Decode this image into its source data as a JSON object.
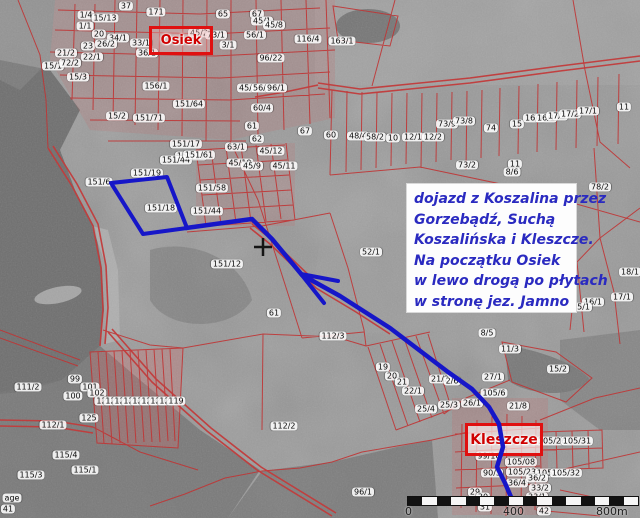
{
  "map": {
    "towns": [
      {
        "name": "Osiek"
      },
      {
        "name": "Kleszcze"
      }
    ],
    "note": {
      "lines": [
        "dojazd z Koszalina przez",
        "Gorzebądź, Suchą",
        "Koszalińska i Kleszcze.",
        "Na początku Osiek",
        "w lewo drogą po płytach",
        "w stronę jez. Jamno"
      ]
    },
    "scalebar": {
      "start_label": "0",
      "mid_label": "400",
      "end_label": "800m",
      "segments": 16
    },
    "colors": {
      "route_blue": "#1616c8",
      "cadastral_red": "#c03434",
      "town_label_red": "#cf0000",
      "note_text_blue": "#2a2ac0",
      "background_gray": "#989898"
    },
    "route": {
      "points": "186,228 252,219 272,239 302,275 340,296 390,328 448,372 472,389 489,407 499,424 503,447 497,467 505,483 511,497",
      "arrow_points": "338,281 301,274 324,303",
      "highlight_polygon": "111,183 167,177 187,228 143,234"
    },
    "parcel_labels": [
      {
        "t": "37",
        "x": 126,
        "y": 6
      },
      {
        "t": "1/4",
        "x": 86,
        "y": 15
      },
      {
        "t": "15/13",
        "x": 105,
        "y": 18
      },
      {
        "t": "171",
        "x": 156,
        "y": 12
      },
      {
        "t": "65",
        "x": 223,
        "y": 14
      },
      {
        "t": "67",
        "x": 257,
        "y": 14
      },
      {
        "t": "45/1",
        "x": 262,
        "y": 21
      },
      {
        "t": "45/8",
        "x": 274,
        "y": 25
      },
      {
        "t": "1/1",
        "x": 85,
        "y": 26
      },
      {
        "t": "20",
        "x": 99,
        "y": 34
      },
      {
        "t": "34/1",
        "x": 118,
        "y": 38
      },
      {
        "t": "23",
        "x": 88,
        "y": 46
      },
      {
        "t": "26/2",
        "x": 106,
        "y": 44
      },
      {
        "t": "33/1",
        "x": 141,
        "y": 43
      },
      {
        "t": "36/1",
        "x": 147,
        "y": 53
      },
      {
        "t": "21/2",
        "x": 66,
        "y": 53
      },
      {
        "t": "22/1",
        "x": 92,
        "y": 57
      },
      {
        "t": "15/1",
        "x": 53,
        "y": 66
      },
      {
        "t": "72/2",
        "x": 70,
        "y": 63
      },
      {
        "t": "15/3",
        "x": 78,
        "y": 77
      },
      {
        "t": "45/2",
        "x": 199,
        "y": 33
      },
      {
        "t": "73/1",
        "x": 216,
        "y": 35
      },
      {
        "t": "3/1",
        "x": 228,
        "y": 45
      },
      {
        "t": "56/1",
        "x": 255,
        "y": 35
      },
      {
        "t": "96/22",
        "x": 271,
        "y": 58
      },
      {
        "t": "116/4",
        "x": 308,
        "y": 39
      },
      {
        "t": "45/7",
        "x": 248,
        "y": 88
      },
      {
        "t": "56/7",
        "x": 262,
        "y": 88
      },
      {
        "t": "96/1",
        "x": 276,
        "y": 88
      },
      {
        "t": "156/1",
        "x": 156,
        "y": 86
      },
      {
        "t": "151/64",
        "x": 189,
        "y": 104
      },
      {
        "t": "15/2",
        "x": 117,
        "y": 116
      },
      {
        "t": "151/71",
        "x": 149,
        "y": 118
      },
      {
        "t": "60/4",
        "x": 262,
        "y": 108
      },
      {
        "t": "61",
        "x": 252,
        "y": 126
      },
      {
        "t": "67",
        "x": 305,
        "y": 131
      },
      {
        "t": "62",
        "x": 257,
        "y": 139
      },
      {
        "t": "63/1",
        "x": 236,
        "y": 147
      },
      {
        "t": "45/12",
        "x": 271,
        "y": 151
      },
      {
        "t": "45/10",
        "x": 240,
        "y": 163
      },
      {
        "t": "45/9",
        "x": 252,
        "y": 166
      },
      {
        "t": "45/11",
        "x": 284,
        "y": 166
      },
      {
        "t": "151/17",
        "x": 186,
        "y": 144
      },
      {
        "t": "151/11",
        "x": 191,
        "y": 156
      },
      {
        "t": "151/19",
        "x": 147,
        "y": 173
      },
      {
        "t": "151/6",
        "x": 99,
        "y": 182
      },
      {
        "t": "151/44",
        "x": 176,
        "y": 160
      },
      {
        "t": "151/61",
        "x": 199,
        "y": 155
      },
      {
        "t": "151/58",
        "x": 212,
        "y": 188
      },
      {
        "t": "151/44",
        "x": 207,
        "y": 211
      },
      {
        "t": "151/18",
        "x": 161,
        "y": 208
      },
      {
        "t": "151/12",
        "x": 227,
        "y": 264
      },
      {
        "t": "163/1",
        "x": 342,
        "y": 41
      },
      {
        "t": "60",
        "x": 331,
        "y": 135
      },
      {
        "t": "48/4",
        "x": 358,
        "y": 136
      },
      {
        "t": "58/2",
        "x": 375,
        "y": 137
      },
      {
        "t": "10",
        "x": 393,
        "y": 138
      },
      {
        "t": "12/1",
        "x": 413,
        "y": 137
      },
      {
        "t": "12/2",
        "x": 433,
        "y": 137
      },
      {
        "t": "73/9",
        "x": 447,
        "y": 124
      },
      {
        "t": "73/8",
        "x": 464,
        "y": 121
      },
      {
        "t": "74",
        "x": 491,
        "y": 128
      },
      {
        "t": "15",
        "x": 517,
        "y": 124
      },
      {
        "t": "16/4",
        "x": 534,
        "y": 118
      },
      {
        "t": "16/1",
        "x": 546,
        "y": 118
      },
      {
        "t": "17/3",
        "x": 557,
        "y": 116
      },
      {
        "t": "17/2",
        "x": 570,
        "y": 114
      },
      {
        "t": "17/1",
        "x": 588,
        "y": 111
      },
      {
        "t": "11",
        "x": 624,
        "y": 107
      },
      {
        "t": "73/2",
        "x": 467,
        "y": 165
      },
      {
        "t": "11",
        "x": 515,
        "y": 164
      },
      {
        "t": "8/6",
        "x": 512,
        "y": 172
      },
      {
        "t": "78/2",
        "x": 600,
        "y": 187
      },
      {
        "t": "52/1",
        "x": 371,
        "y": 252
      },
      {
        "t": "18/1",
        "x": 630,
        "y": 272
      },
      {
        "t": "17/1",
        "x": 622,
        "y": 297
      },
      {
        "t": "16/1",
        "x": 593,
        "y": 302
      },
      {
        "t": "15/1",
        "x": 581,
        "y": 307
      },
      {
        "t": "61",
        "x": 274,
        "y": 313
      },
      {
        "t": "112/3",
        "x": 333,
        "y": 336
      },
      {
        "t": "111/2",
        "x": 28,
        "y": 387
      },
      {
        "t": "99",
        "x": 75,
        "y": 379
      },
      {
        "t": "101",
        "x": 90,
        "y": 387
      },
      {
        "t": "102",
        "x": 97,
        "y": 393
      },
      {
        "t": "100",
        "x": 73,
        "y": 396
      },
      {
        "t": "125",
        "x": 89,
        "y": 418
      },
      {
        "t": "112/1",
        "x": 53,
        "y": 425
      },
      {
        "t": "115/4",
        "x": 66,
        "y": 455
      },
      {
        "t": "115/1",
        "x": 85,
        "y": 470
      },
      {
        "t": "115/3",
        "x": 31,
        "y": 475
      },
      {
        "t": "121",
        "x": 104,
        "y": 401
      },
      {
        "t": "124",
        "x": 113,
        "y": 401
      },
      {
        "t": "125",
        "x": 122,
        "y": 401
      },
      {
        "t": "126",
        "x": 131,
        "y": 401
      },
      {
        "t": "127",
        "x": 140,
        "y": 401
      },
      {
        "t": "128",
        "x": 149,
        "y": 401
      },
      {
        "t": "129",
        "x": 158,
        "y": 401
      },
      {
        "t": "122",
        "x": 167,
        "y": 401
      },
      {
        "t": "119",
        "x": 176,
        "y": 401
      },
      {
        "t": "112/2",
        "x": 284,
        "y": 426
      },
      {
        "t": "19",
        "x": 383,
        "y": 367
      },
      {
        "t": "20",
        "x": 392,
        "y": 376
      },
      {
        "t": "21",
        "x": 402,
        "y": 382
      },
      {
        "t": "22/1",
        "x": 413,
        "y": 391
      },
      {
        "t": "21/2",
        "x": 440,
        "y": 379
      },
      {
        "t": "2/6",
        "x": 452,
        "y": 381
      },
      {
        "t": "25/4",
        "x": 426,
        "y": 409
      },
      {
        "t": "25/3",
        "x": 449,
        "y": 405
      },
      {
        "t": "26/1",
        "x": 472,
        "y": 403
      },
      {
        "t": "96/1",
        "x": 363,
        "y": 492
      },
      {
        "t": "8/5",
        "x": 487,
        "y": 333
      },
      {
        "t": "11/3",
        "x": 510,
        "y": 349
      },
      {
        "t": "15/2",
        "x": 558,
        "y": 369
      },
      {
        "t": "27/1",
        "x": 493,
        "y": 377
      },
      {
        "t": "105/6",
        "x": 494,
        "y": 393
      },
      {
        "t": "21/8",
        "x": 518,
        "y": 406
      },
      {
        "t": "105/26",
        "x": 552,
        "y": 441
      },
      {
        "t": "105/31",
        "x": 577,
        "y": 441
      },
      {
        "t": "99/16",
        "x": 489,
        "y": 456
      },
      {
        "t": "105/08",
        "x": 521,
        "y": 462
      },
      {
        "t": "90/3",
        "x": 492,
        "y": 473
      },
      {
        "t": "105/23",
        "x": 522,
        "y": 472
      },
      {
        "t": "105/33",
        "x": 551,
        "y": 473
      },
      {
        "t": "105/32",
        "x": 566,
        "y": 473
      },
      {
        "t": "36/4",
        "x": 517,
        "y": 483
      },
      {
        "t": "36/2",
        "x": 537,
        "y": 478
      },
      {
        "t": "33/2",
        "x": 540,
        "y": 488
      },
      {
        "t": "29",
        "x": 475,
        "y": 492
      },
      {
        "t": "33/1",
        "x": 537,
        "y": 497
      },
      {
        "t": "30",
        "x": 483,
        "y": 497
      },
      {
        "t": "31",
        "x": 485,
        "y": 507
      },
      {
        "t": "42",
        "x": 544,
        "y": 511
      },
      {
        "t": "age",
        "x": 12,
        "y": 498
      },
      {
        "t": "41",
        "x": 8,
        "y": 509
      }
    ]
  }
}
